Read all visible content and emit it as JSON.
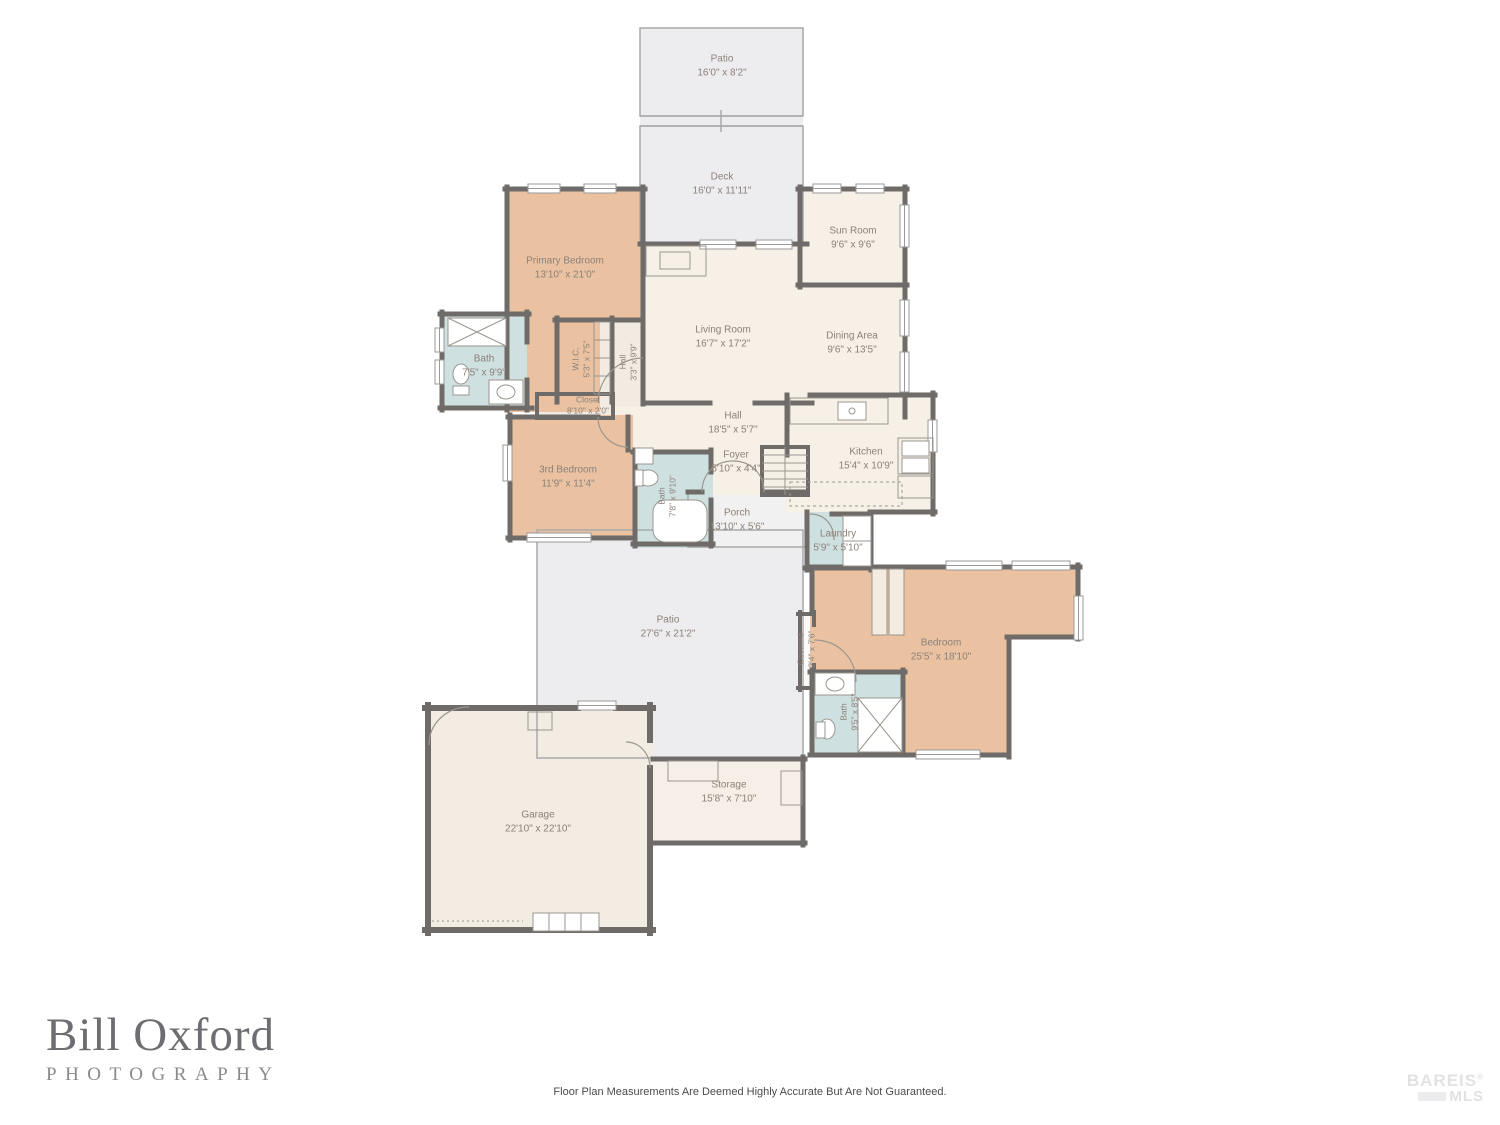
{
  "palette": {
    "wall": "#6f6b68",
    "bedroom_fill": "#eac2a1",
    "bath_fill": "#cfe0e0",
    "living_fill": "#f7f0e7",
    "garage_fill": "#f3ece3",
    "outdoor_fill": "#ededef",
    "label_text": "#8b8179"
  },
  "rooms": [
    {
      "name": "Patio",
      "dims": "16'0\" x 8'2\""
    },
    {
      "name": "Deck",
      "dims": "16'0\" x 11'11\""
    },
    {
      "name": "Sun Room",
      "dims": "9'6\" x 9'6\""
    },
    {
      "name": "Primary Bedroom",
      "dims": "13'10\" x 21'0\""
    },
    {
      "name": "Living Room",
      "dims": "16'7\" x 17'2\""
    },
    {
      "name": "Dining Area",
      "dims": "9'6\" x 13'5\""
    },
    {
      "name": "Bath",
      "dims": "7'5\" x 9'9\""
    },
    {
      "name": "W.I.C.",
      "dims": "5'3\" x 7'5\""
    },
    {
      "name": "Hall",
      "dims": "3'3\" x 9'9\""
    },
    {
      "name": "Closet",
      "dims": "8'10\" x 2'0\""
    },
    {
      "name": "Hall",
      "dims": "18'5\" x 5'7\""
    },
    {
      "name": "3rd Bedroom",
      "dims": "11'9\" x 11'4\""
    },
    {
      "name": "Bath",
      "dims": "7'8\" x 9'10\""
    },
    {
      "name": "Foyer",
      "dims": "5'10\" x 4'4\""
    },
    {
      "name": "Kitchen",
      "dims": "15'4\" x 10'9\""
    },
    {
      "name": "Porch",
      "dims": "13'10\" x 5'6\""
    },
    {
      "name": "Laundry",
      "dims": "5'9\" x 5'10\""
    },
    {
      "name": "Patio",
      "dims": "27'6\" x 21'2\""
    },
    {
      "name": "Covered",
      "dims": "2'4\" x 7'6\""
    },
    {
      "name": "Bedroom",
      "dims": "25'5\" x 18'10\""
    },
    {
      "name": "Bath",
      "dims": "9'5\" x 8'5\""
    },
    {
      "name": "Garage",
      "dims": "22'10\" x 22'10\""
    },
    {
      "name": "Storage",
      "dims": "15'8\" x 7'10\""
    }
  ],
  "footer": {
    "logo_line1": "Bill Oxford",
    "logo_line2": "PHOTOGRAPHY",
    "disclaimer": "Floor Plan Measurements Are Deemed Highly Accurate But Are Not Guaranteed.",
    "watermark_line1": "BAREIS",
    "watermark_reg": "®",
    "watermark_line2": "MLS"
  }
}
